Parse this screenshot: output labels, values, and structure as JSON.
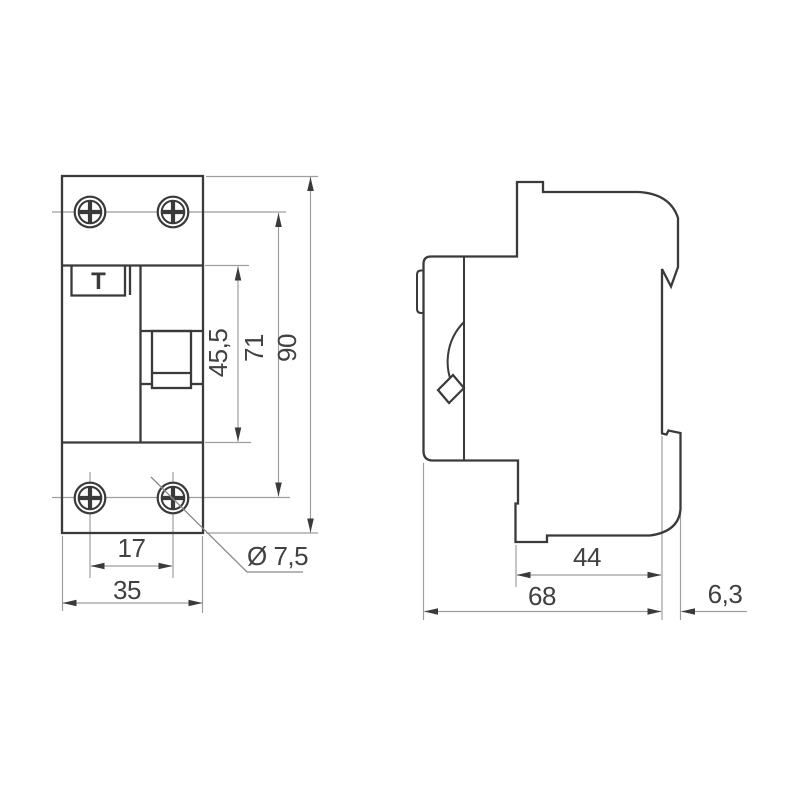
{
  "drawing": {
    "front_view": {
      "test_button_label": "T",
      "dims": {
        "window_height": "45,5",
        "hole_rows_spacing": "71",
        "total_height": "90",
        "hole_columns_spacing": "17",
        "width": "35",
        "hole_diameter": "Ø 7,5"
      }
    },
    "side_view": {
      "dims": {
        "rail_offset": "44",
        "depth": "68",
        "clip_protrusion": "6,3"
      }
    }
  }
}
